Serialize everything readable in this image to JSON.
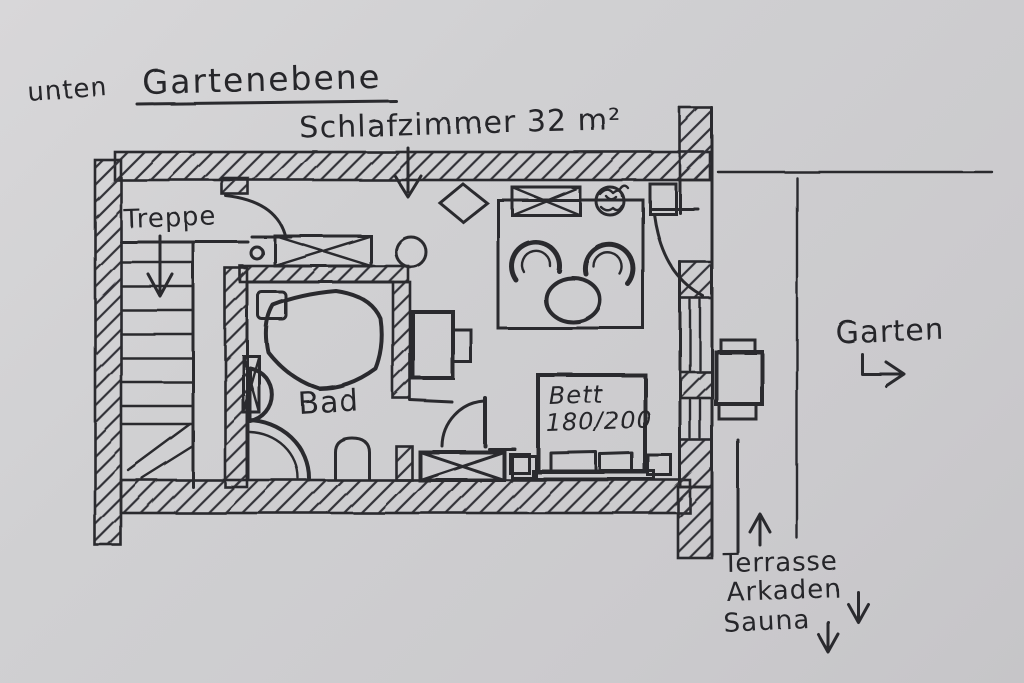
{
  "palette": {
    "paper": "#cfcfd1",
    "ink": "#2a2a2e"
  },
  "header": {
    "level_hint": "unten",
    "title": "Gartenebene"
  },
  "room": {
    "name_and_area": "Schlafzimmer 32 m²"
  },
  "areas": {
    "stairs": "Treppe",
    "bathroom": "Bad"
  },
  "furniture": {
    "bed_label": "Bett",
    "bed_size": "180/200"
  },
  "outside": {
    "garden": "Garten",
    "terrace": "Terrasse",
    "arcades": "Arkaden",
    "sauna": "Sauna"
  }
}
